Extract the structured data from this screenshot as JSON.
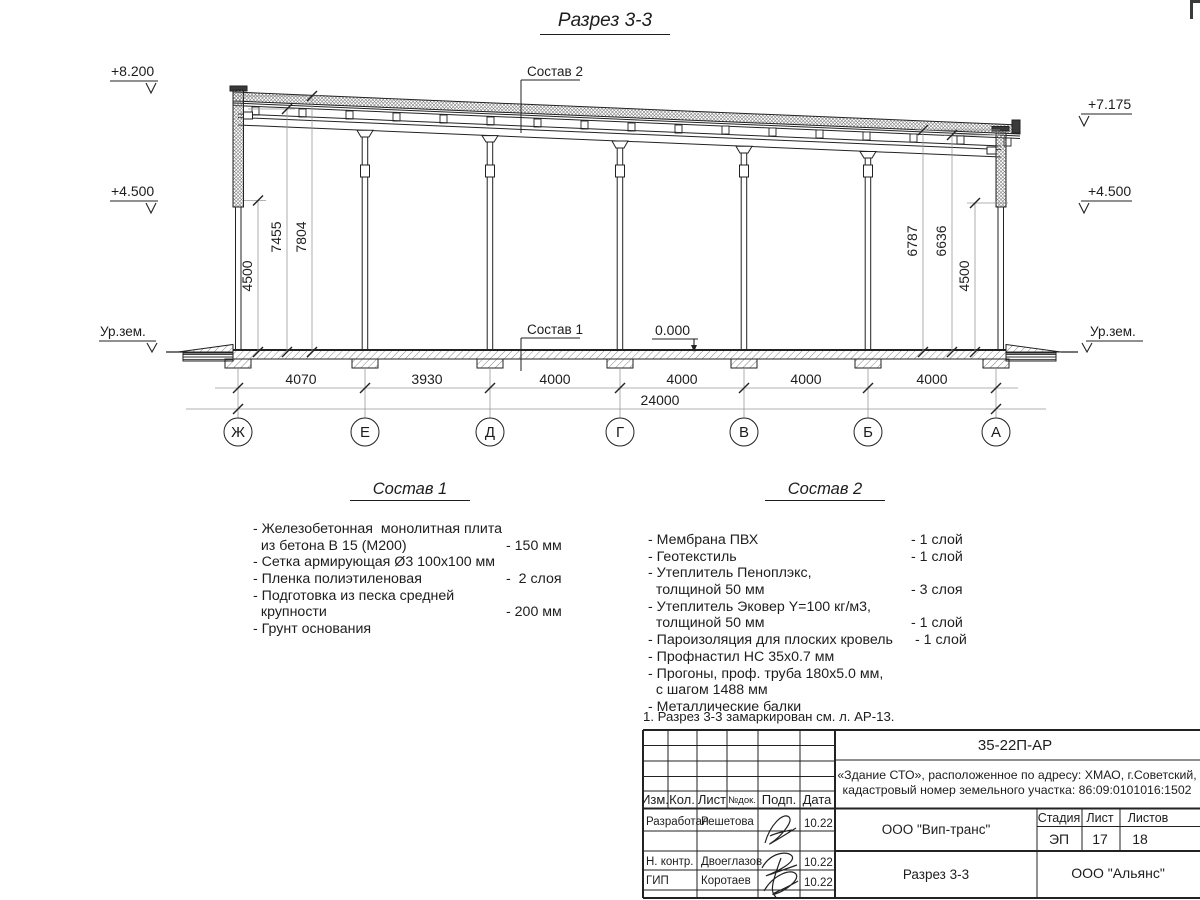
{
  "title": "Разрез 3-3",
  "drawing": {
    "lev_left_top": "+8.200",
    "lev_left_mid": "+4.500",
    "lev_left_ground": "Ур.зем.",
    "lev_right_top": "+7.175",
    "lev_right_mid": "+4.500",
    "lev_right_ground": "Ур.зем.",
    "lev_zero": "0.000",
    "leader_sostav1": "Состав 1",
    "leader_sostav2": "Состав 2",
    "dims_left": [
      "4500",
      "7455",
      "7804"
    ],
    "dims_right": [
      "6787",
      "6636",
      "4500"
    ],
    "dims_bottom": [
      "4070",
      "3930",
      "4000",
      "4000",
      "4000",
      "4000"
    ],
    "dim_total": "24000",
    "axes": [
      "Ж",
      "Е",
      "Д",
      "Г",
      "В",
      "Б",
      "А"
    ]
  },
  "comp1": {
    "heading": "Состав 1",
    "rows": [
      {
        "l": "- Железобетонная  монолитная плита",
        "v": ""
      },
      {
        "l": "  из бетона В 15 (М200)",
        "v": "- 150 мм"
      },
      {
        "l": "- Сетка армирующая Ø3 100х100 мм",
        "v": ""
      },
      {
        "l": "- Пленка полиэтиленовая",
        "v": "-  2 слоя"
      },
      {
        "l": "- Подготовка из песка средней",
        "v": ""
      },
      {
        "l": "  крупности",
        "v": "- 200 мм"
      },
      {
        "l": "- Грунт основания",
        "v": ""
      }
    ]
  },
  "comp2": {
    "heading": "Состав 2",
    "rows": [
      {
        "l": "- Мембрана ПВХ",
        "v": "- 1 слой"
      },
      {
        "l": "- Геотекстиль",
        "v": "- 1 слой"
      },
      {
        "l": "- Утеплитель Пеноплэкс,",
        "v": ""
      },
      {
        "l": "  толщиной 50 мм",
        "v": "- 3 слоя"
      },
      {
        "l": "- Утеплитель Эковер Y=100 кг/м3,",
        "v": ""
      },
      {
        "l": "  толщиной 50 мм",
        "v": "- 1 слой"
      },
      {
        "l": "- Пароизоляция для плоских кровель",
        "v": " - 1 слой"
      },
      {
        "l": "- Профнастил НС 35х0.7 мм",
        "v": ""
      },
      {
        "l": "- Прогоны, проф. труба 180х5.0 мм,",
        "v": ""
      },
      {
        "l": "  с шагом 1488 мм",
        "v": ""
      },
      {
        "l": "- Металлические балки",
        "v": ""
      }
    ]
  },
  "note": "1. Разрез 3-3 замаркирован см. л. АР-13.",
  "titleblock": {
    "doc_number": "35-22П-АР",
    "object_line1": "«Здание СТО», расположенное по адресу: ХМАО, г.Советский,",
    "object_line2": "кадастровый номер земельного участка: 86:09:0101016:1502",
    "header_cols": [
      "Изм.",
      "Кол.",
      "Лист",
      "№док.",
      "Подп.",
      "Дата"
    ],
    "rows": [
      {
        "role": "Разработал",
        "name": "Решетова",
        "date": "10.22"
      },
      {
        "role": "Н. контр.",
        "name": "Двоеглазов",
        "date": "10.22"
      },
      {
        "role": "ГИП",
        "name": "Коротаев",
        "date": "10.22"
      }
    ],
    "company": "ООО \"Вип-транс\"",
    "sheet_title": "Разрез 3-3",
    "firm": "ООО \"Альянс\"",
    "stage_label": "Стадия",
    "sheet_label": "Лист",
    "sheets_label": "Листов",
    "stage": "ЭП",
    "sheet": "17",
    "sheets": "18"
  }
}
